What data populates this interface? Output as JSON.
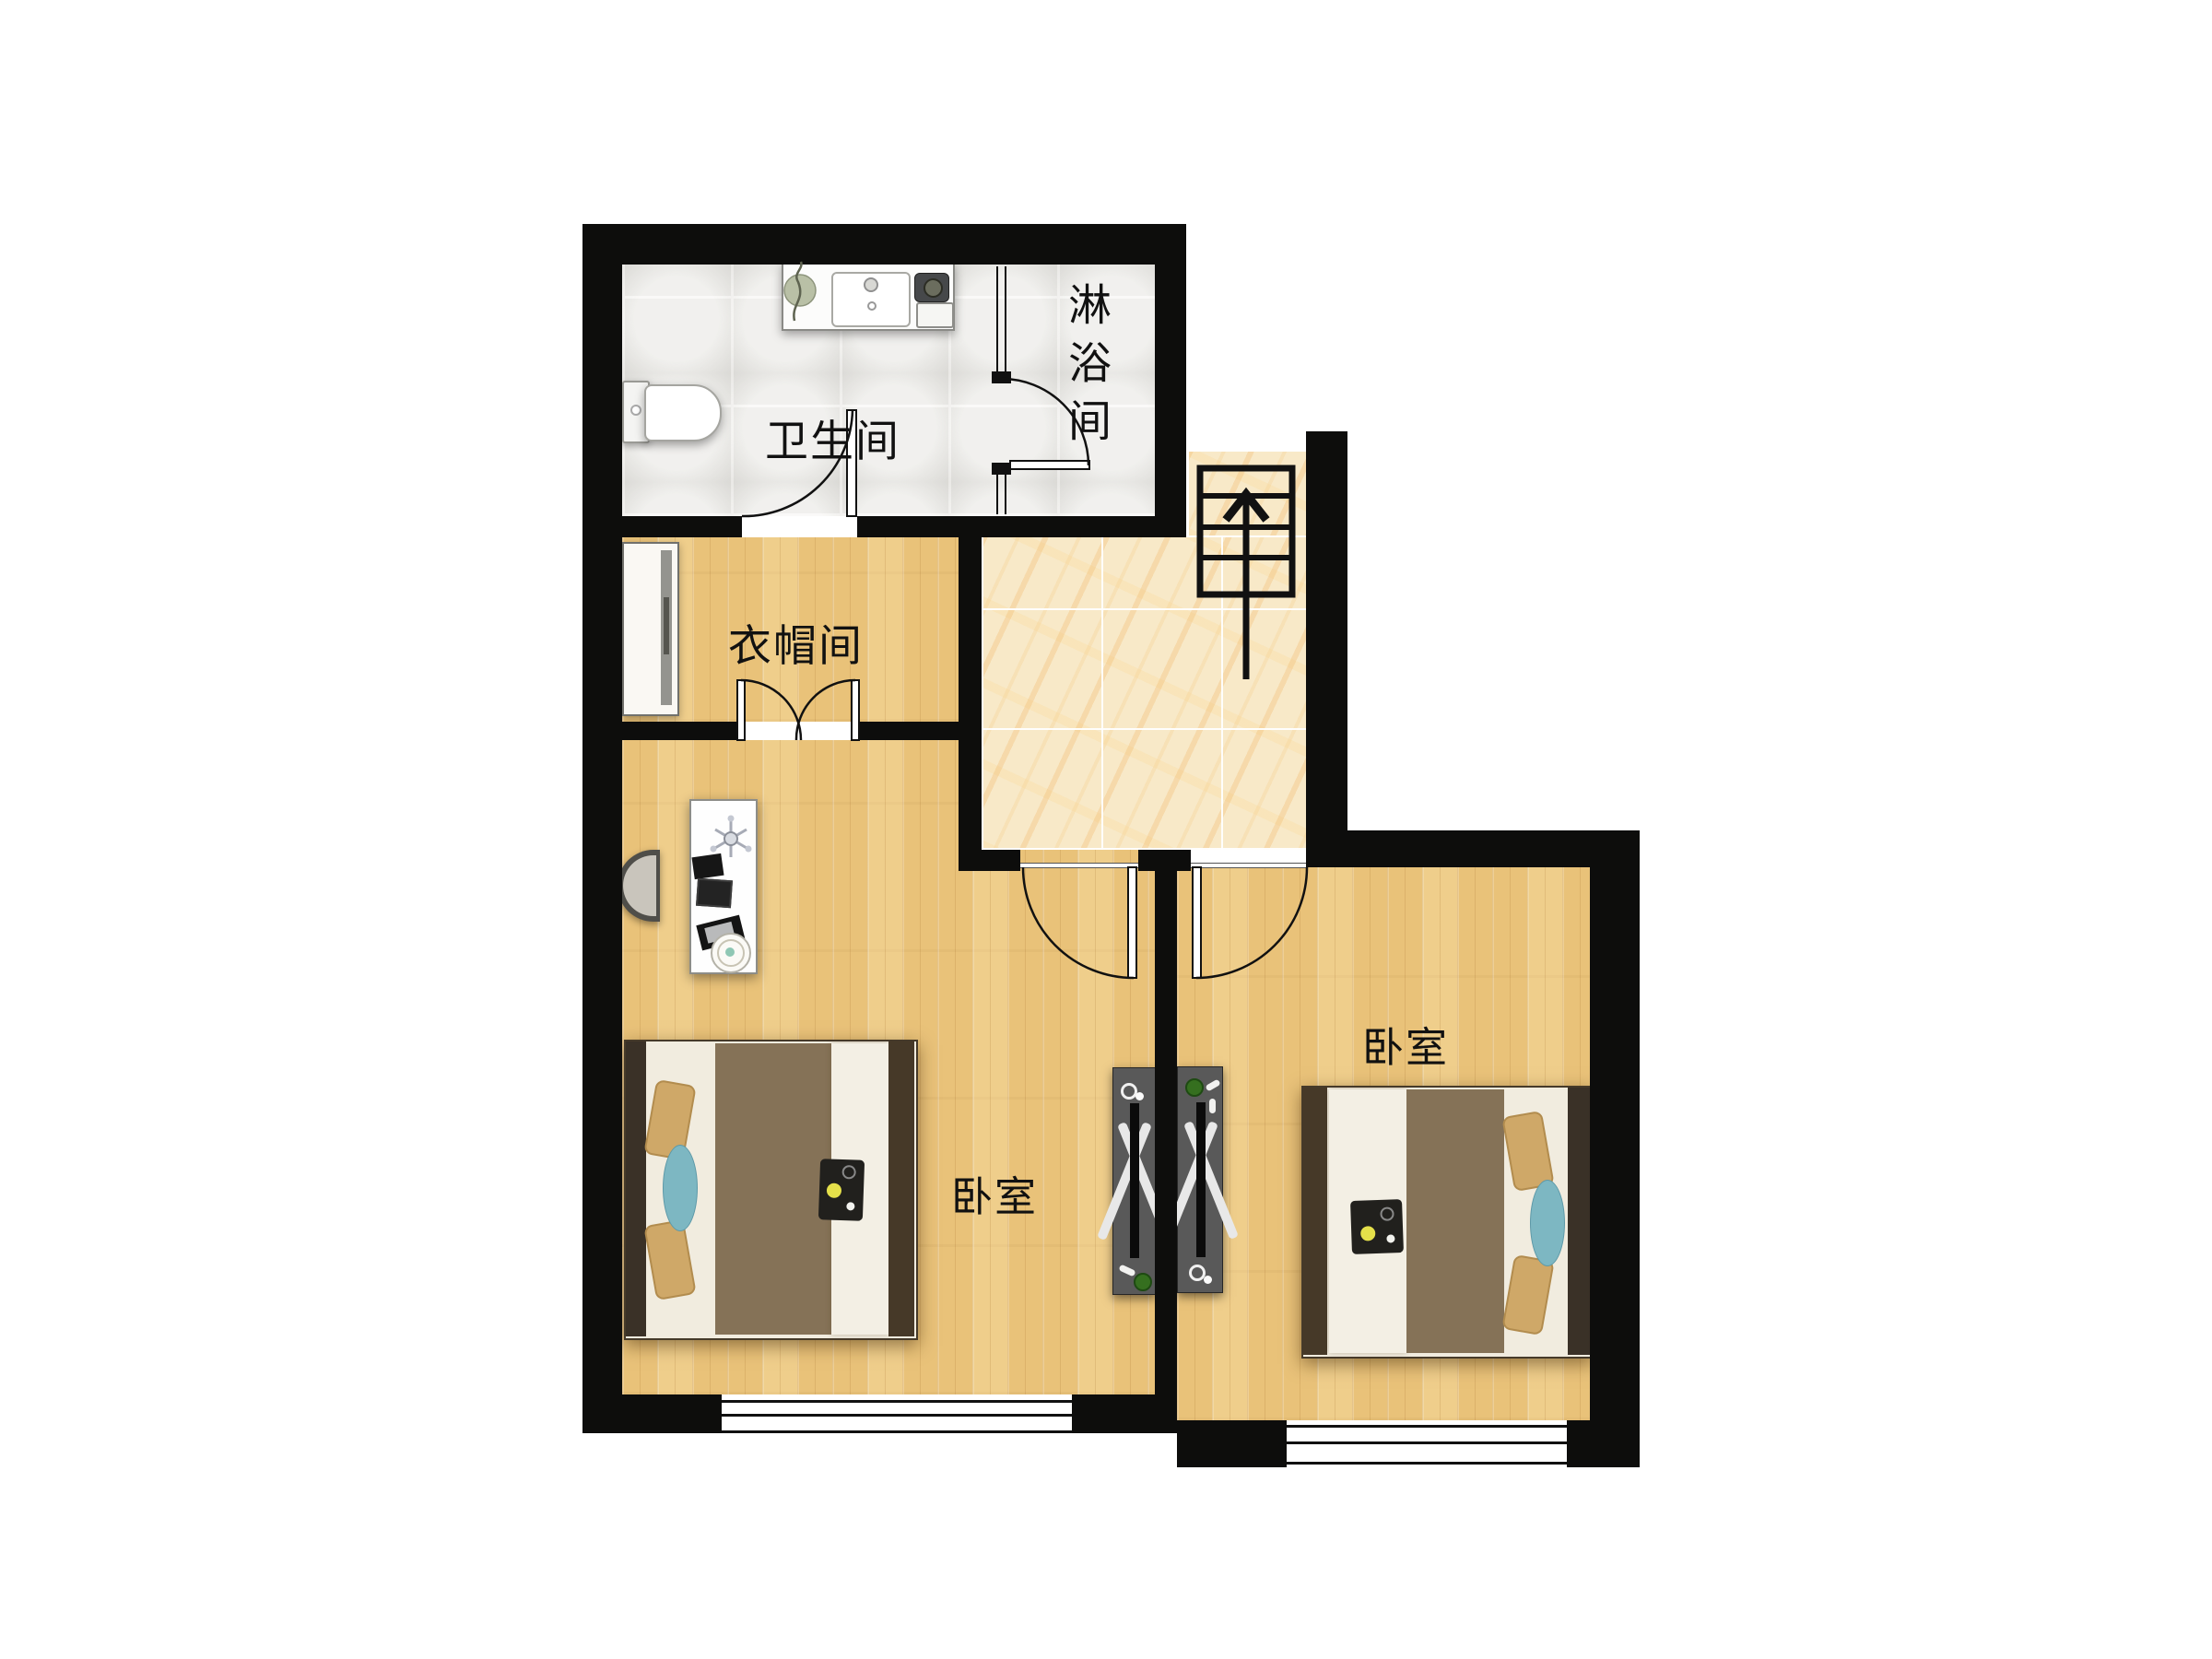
{
  "floorplan": {
    "kind": "residential-floor-plan",
    "language": "zh-CN",
    "rooms": [
      {
        "id": "bathroom",
        "label": "卫生间"
      },
      {
        "id": "shower-room",
        "label": "淋浴间",
        "label_orientation": "vertical"
      },
      {
        "id": "cloakroom",
        "label": "衣帽间"
      },
      {
        "id": "bedroom-left",
        "label": "卧室"
      },
      {
        "id": "bedroom-right",
        "label": "卧室"
      }
    ],
    "stairs": {
      "direction_arrow": "up"
    },
    "furniture": [
      "vanity-counter",
      "washbasin",
      "counter-plant",
      "toilet",
      "glass-shower-door",
      "wardrobe",
      "double-swing-door",
      "desk",
      "office-chair",
      "laptop",
      "robot-vacuum",
      "double-bed",
      "double-bed",
      "tv-stand",
      "tv-stand",
      "staircase",
      "window",
      "window"
    ],
    "colors": {
      "wall": "#0d0d0c",
      "wood_floor": "#e9c279",
      "wood_plank_line": "#d9a85e",
      "marble_floor": "#f8e9c8",
      "marble_vein": "#f0cd92",
      "bath_tile": "#e8e7e3",
      "tile_joint": "#f7f6f3",
      "blanket_brown": "#857257",
      "mattress_white": "#f1ecdf",
      "pillow_tan": "#cfa868",
      "pillow_teal": "#7db7c2",
      "tv_stand_gray": "#595959",
      "label_text": "#111111",
      "background": "#ffffff"
    }
  }
}
